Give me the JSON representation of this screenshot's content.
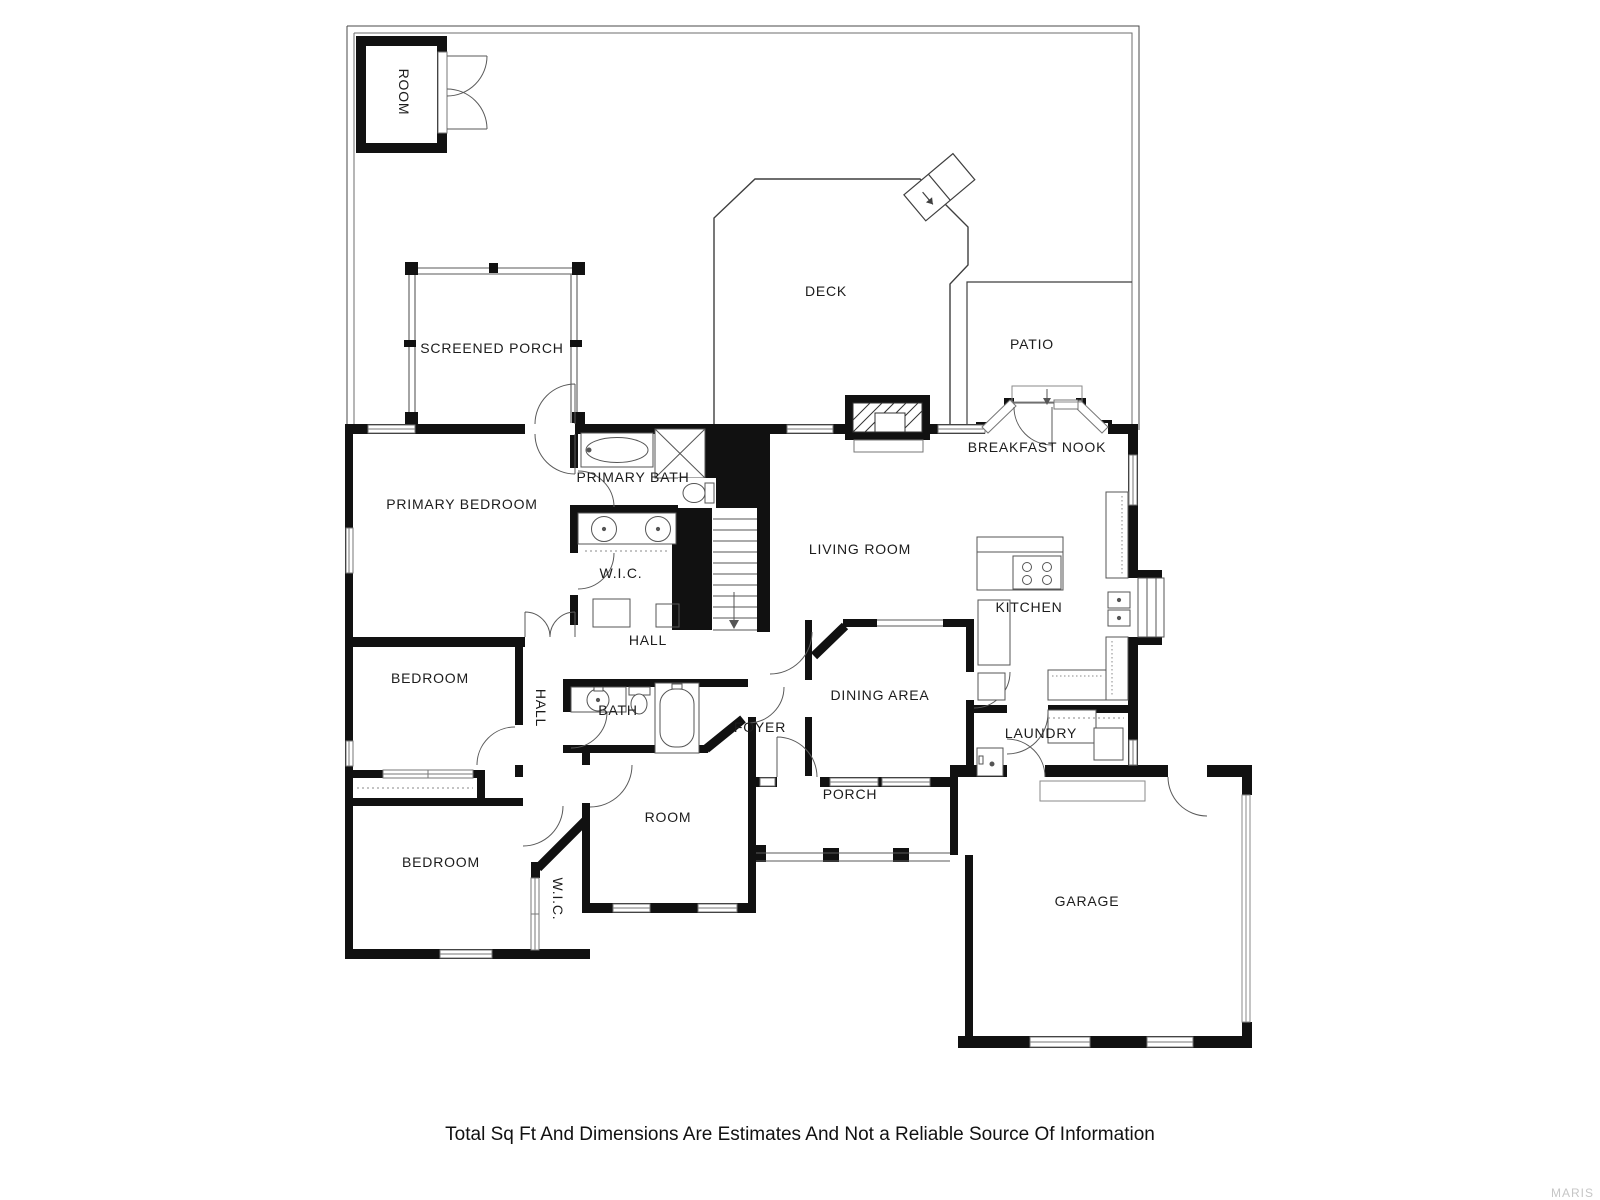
{
  "colors": {
    "wall": "#111111",
    "line": "#3f3f3f",
    "thin": "#777777",
    "label": "#1c1c1c",
    "watermark": "#c6c6c6"
  },
  "labels": {
    "room_outbuilding": "ROOM",
    "screened_porch": "SCREENED PORCH",
    "deck": "DECK",
    "patio": "PATIO",
    "breakfast_nook": "BREAKFAST NOOK",
    "primary_bedroom": "PRIMARY BEDROOM",
    "primary_bath": "PRIMARY BATH",
    "wic_primary": "W.I.C.",
    "living_room": "LIVING ROOM",
    "kitchen": "KITCHEN",
    "hall_upper": "HALL",
    "hall_lower": "HALL",
    "bedroom_mid": "BEDROOM",
    "bath": "BATH",
    "dining_area": "DINING AREA",
    "foyer": "FOYER",
    "laundry": "LAUNDRY",
    "room_lower": "ROOM",
    "porch": "PORCH",
    "bedroom_lower": "BEDROOM",
    "wic_lower": "W.I.C.",
    "garage": "GARAGE"
  },
  "footer": {
    "disclaimer": "Total Sq Ft And Dimensions Are Estimates And Not a Reliable Source Of Information",
    "watermark": "MARIS"
  }
}
